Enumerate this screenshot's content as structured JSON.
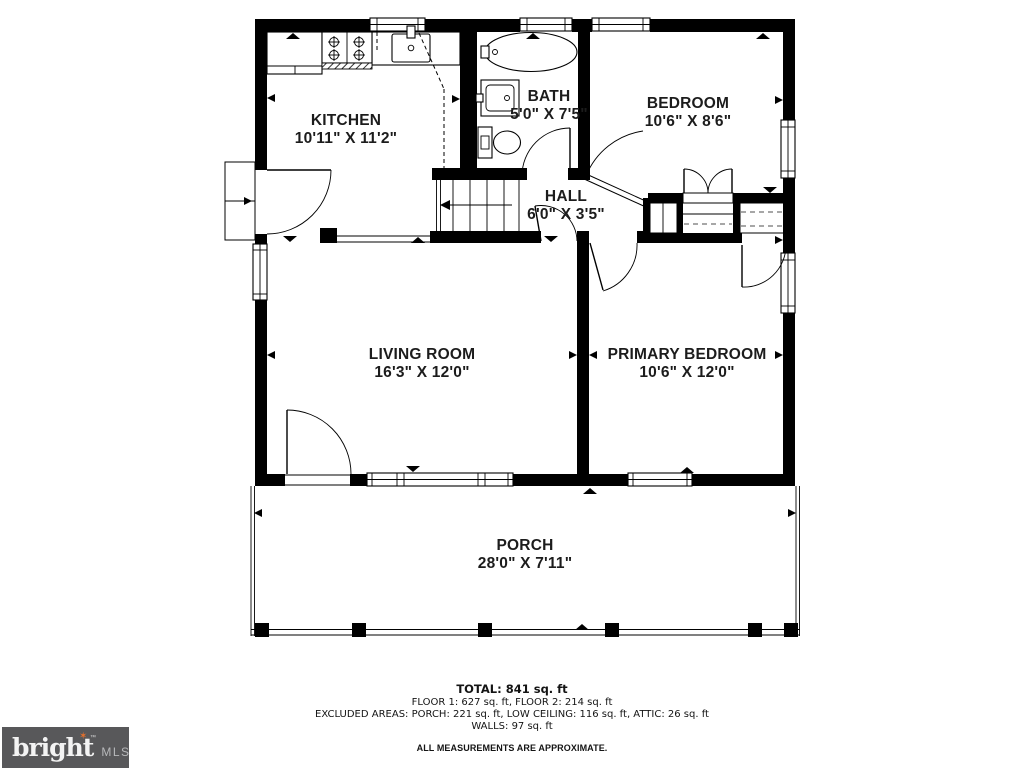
{
  "rooms": [
    {
      "id": "kitchen",
      "name": "KITCHEN",
      "dims": "10'11\" X 11'2\""
    },
    {
      "id": "bath",
      "name": "BATH",
      "dims": "5'0\" X 7'5\""
    },
    {
      "id": "bedroom",
      "name": "BEDROOM",
      "dims": "10'6\" X 8'6\""
    },
    {
      "id": "hall",
      "name": "HALL",
      "dims": "6'0\" X 3'5\""
    },
    {
      "id": "living-room",
      "name": "LIVING ROOM",
      "dims": "16'3\" X 12'0\""
    },
    {
      "id": "primary-bedroom",
      "name": "PRIMARY BEDROOM",
      "dims": "10'6\" X 12'0\""
    },
    {
      "id": "porch",
      "name": "PORCH",
      "dims": "28'0\" X 7'11\""
    }
  ],
  "footer": {
    "total": "TOTAL: 841 sq. ft",
    "floors": "FLOOR 1: 627 sq. ft, FLOOR 2: 214 sq. ft",
    "excluded": "EXCLUDED AREAS: PORCH: 221 sq. ft, LOW CEILING: 116 sq. ft, ATTIC: 26 sq. ft",
    "walls": "WALLS: 97 sq. ft",
    "disclaimer": "ALL MEASUREMENTS ARE APPROXIMATE."
  },
  "logo": {
    "brand": "bright",
    "tm": "™",
    "suffix": "MLS",
    "star": "✶"
  },
  "colors": {
    "wall": "#000000",
    "background": "#ffffff",
    "logo_background": "#58585a",
    "logo_star": "#e4702d",
    "logo_text": "#f3f3f3",
    "logo_suffix": "#b7b8ba"
  }
}
